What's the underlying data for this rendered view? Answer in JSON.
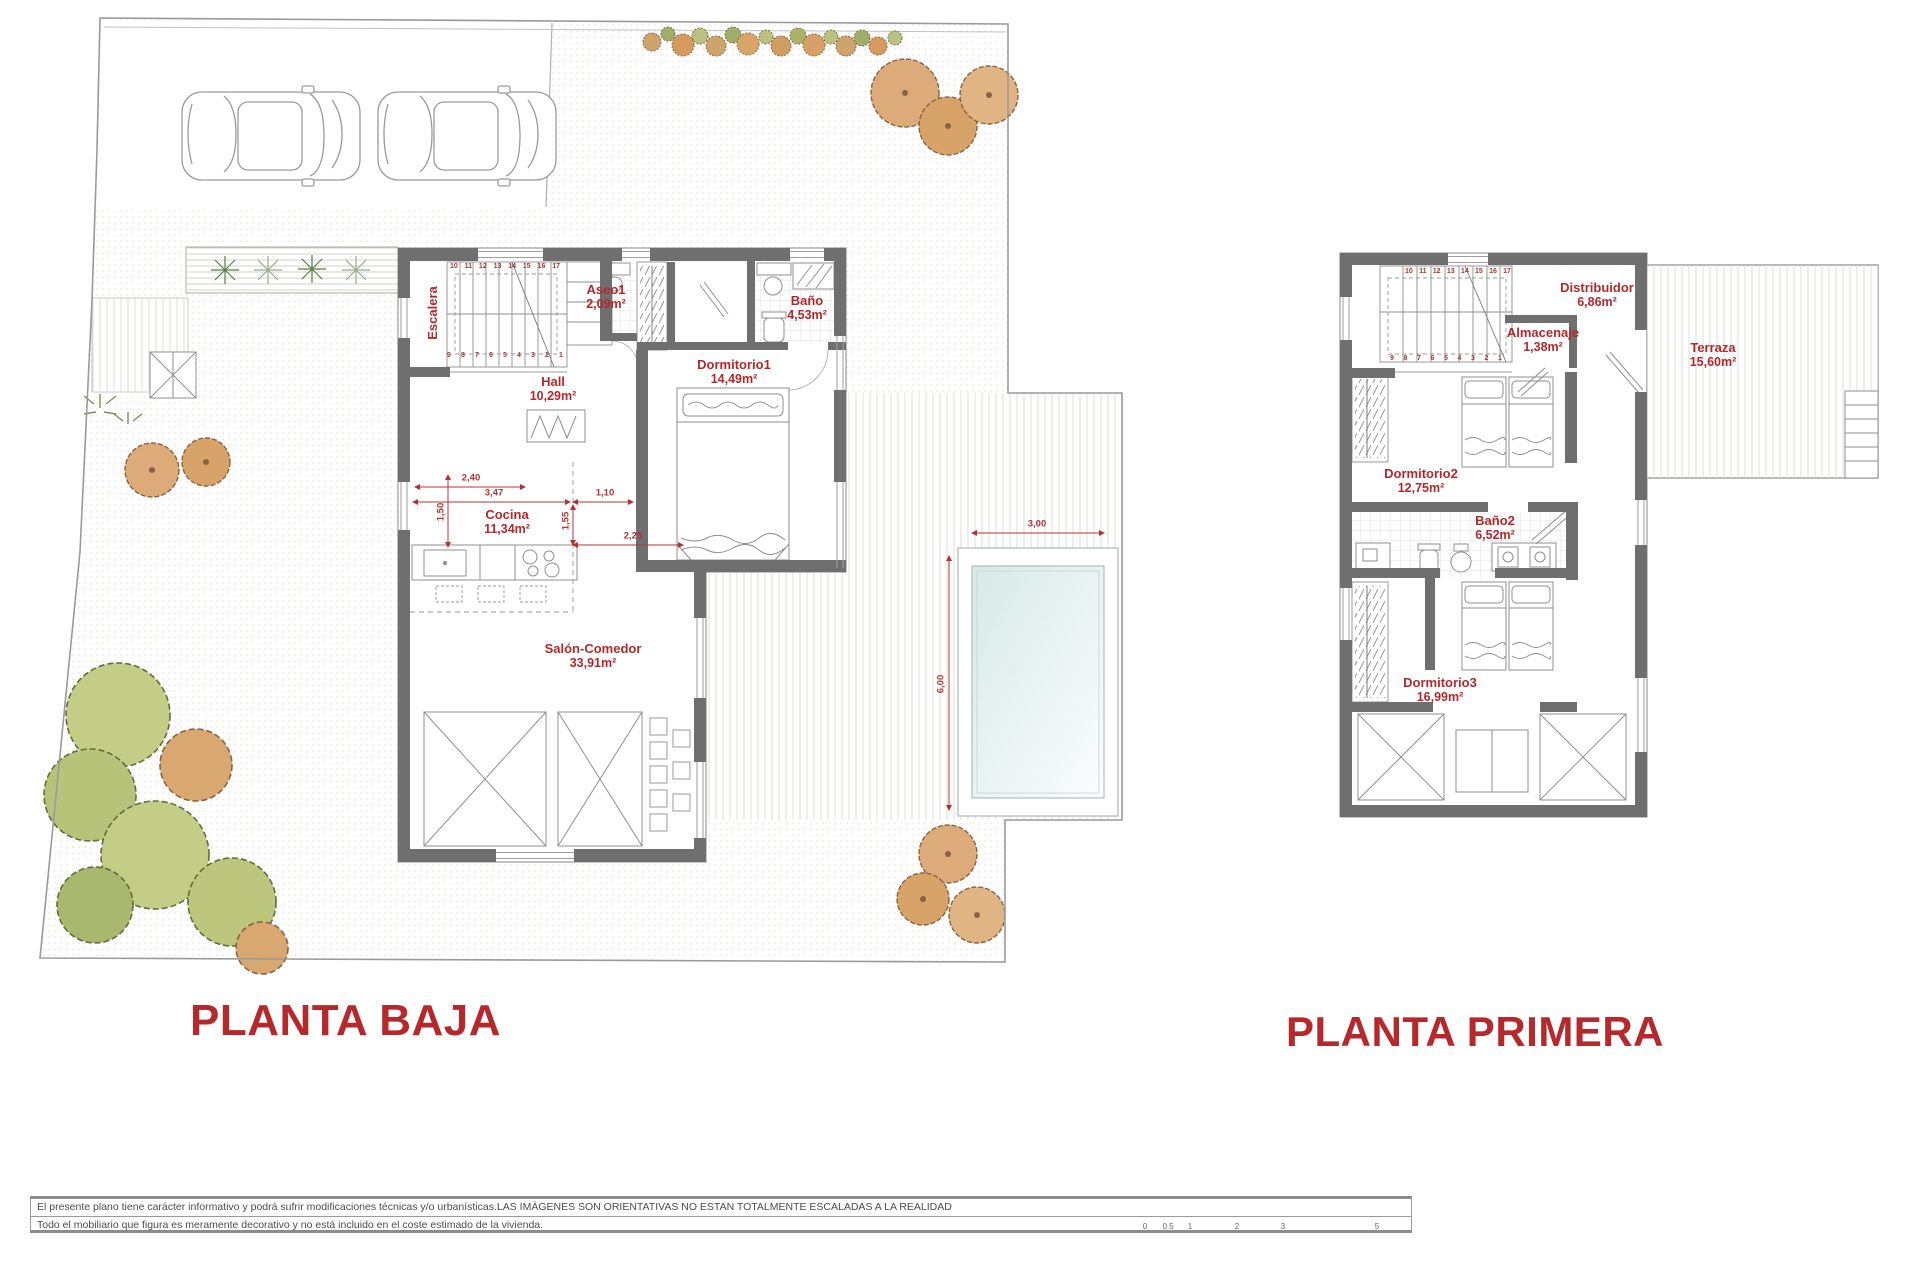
{
  "palette": {
    "accent_red": "#b5292c",
    "dim_red": "#b03434",
    "wall_gray": "#6f6f6f"
  },
  "titles": {
    "ground": "PLANTA BAJA",
    "first": "PLANTA PRIMERA"
  },
  "ground_floor": {
    "rooms": {
      "escalera": {
        "name": "Escalera"
      },
      "aseo1": {
        "name": "Aseo1",
        "area": "2,09m²"
      },
      "bano": {
        "name": "Baño",
        "area": "4,53m²"
      },
      "dormitorio1": {
        "name": "Dormitorio1",
        "area": "14,49m²"
      },
      "hall": {
        "name": "Hall",
        "area": "10,29m²"
      },
      "cocina": {
        "name": "Cocina",
        "area": "11,34m²"
      },
      "salon": {
        "name": "Salón-Comedor",
        "area": "33,91m²"
      }
    },
    "dims": {
      "d1": "2,40",
      "d2": "3,47",
      "d3": "1,10",
      "d4": "1,50",
      "d5": "1,55",
      "d6": "2,25"
    },
    "pool_dims": {
      "w": "3,00",
      "h": "6,00"
    },
    "stairs_top": [
      "10",
      "11",
      "12",
      "13",
      "14",
      "15",
      "16",
      "17"
    ],
    "stairs_bottom": [
      "9",
      "8",
      "7",
      "6",
      "5",
      "4",
      "3",
      "2",
      "1"
    ]
  },
  "first_floor": {
    "rooms": {
      "distribuidor": {
        "name": "Distribuidor",
        "area": "6,86m²"
      },
      "almacenaje": {
        "name": "Almacenaje",
        "area": "1,38m²"
      },
      "terraza": {
        "name": "Terraza",
        "area": "15,60m²"
      },
      "dormitorio2": {
        "name": "Dormitorio2",
        "area": "12,75m²"
      },
      "bano2": {
        "name": "Baño2",
        "area": "6,52m²"
      },
      "dormitorio3": {
        "name": "Dormitorio3",
        "area": "16,99m²"
      }
    },
    "stairs_top": [
      "10",
      "11",
      "12",
      "13",
      "14",
      "15",
      "16",
      "17"
    ],
    "stairs_bottom": [
      "9",
      "8",
      "7",
      "6",
      "5",
      "4",
      "3",
      "2",
      "1"
    ]
  },
  "footer": {
    "line1": "El presente plano tiene carácter informativo y podrá  sufrir modificaciones técnicas y/o urbanísticas.LAS IMÁGENES SON ORIENTATIVAS NO ESTAN TOTALMENTE ESCALADAS A LA REALIDAD",
    "line2": "Todo el mobiliario que figura es meramente decorativo y no está incluido en el coste estimado de la vivienda.",
    "scale_labels": [
      "0",
      "0.5",
      "1",
      "2",
      "3",
      "5"
    ]
  }
}
